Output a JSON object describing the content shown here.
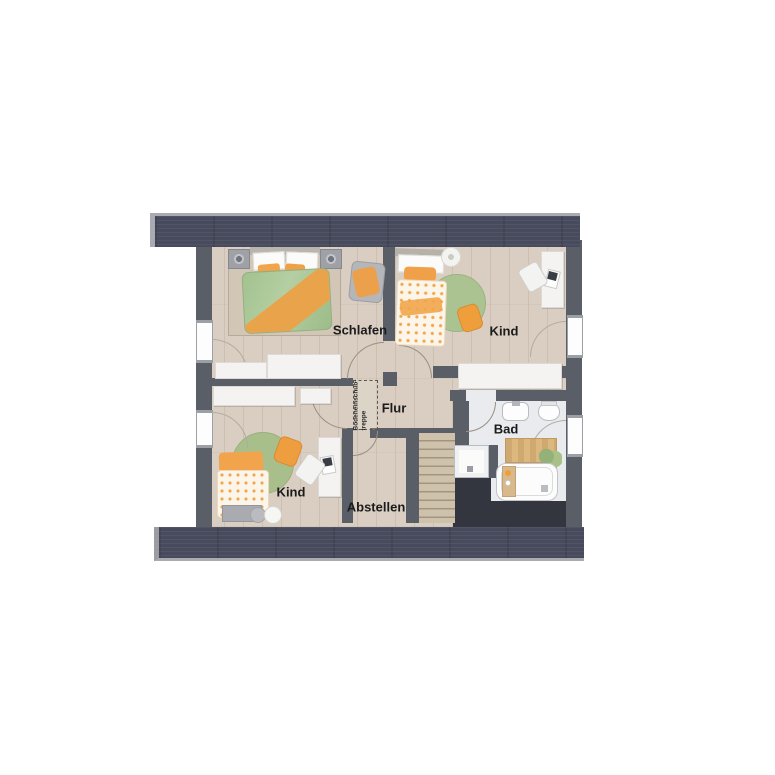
{
  "rooms": {
    "schlafen": {
      "label": "Schlafen"
    },
    "kind_top": {
      "label": "Kind"
    },
    "kind_bottom": {
      "label": "Kind"
    },
    "flur": {
      "label": "Flur"
    },
    "bad": {
      "label": "Bad"
    },
    "abstellen": {
      "label": "Abstellen"
    }
  },
  "annotations": {
    "attic_hatch": {
      "line1": "Bodeneinschub-",
      "line2": "treppe"
    }
  },
  "colors": {
    "background": "#ffffff",
    "roof_band": "#474b5d",
    "roof_band_edge": "#a9abb0",
    "wall": "#5a5e67",
    "floor_wood": "#d9cec1",
    "bad_floor": "#eaebee",
    "void": "#33363e",
    "stairs_wood": "#cfc2ac",
    "accent_orange": "#f0a34a",
    "accent_green": "#a9c18e",
    "label_text": "#1b1b1d"
  },
  "furniture_icons": [
    "double-bed",
    "nightstand",
    "wardrobe",
    "lounge-chair",
    "single-bed",
    "round-rug",
    "floor-cushion",
    "desk",
    "desk-chair",
    "laptop",
    "plant",
    "flower-stool",
    "bench",
    "laundry-basket",
    "staircase",
    "attic-hatch",
    "shower",
    "bathtub",
    "bath-caddy",
    "bath-mat",
    "sink",
    "toilet"
  ]
}
